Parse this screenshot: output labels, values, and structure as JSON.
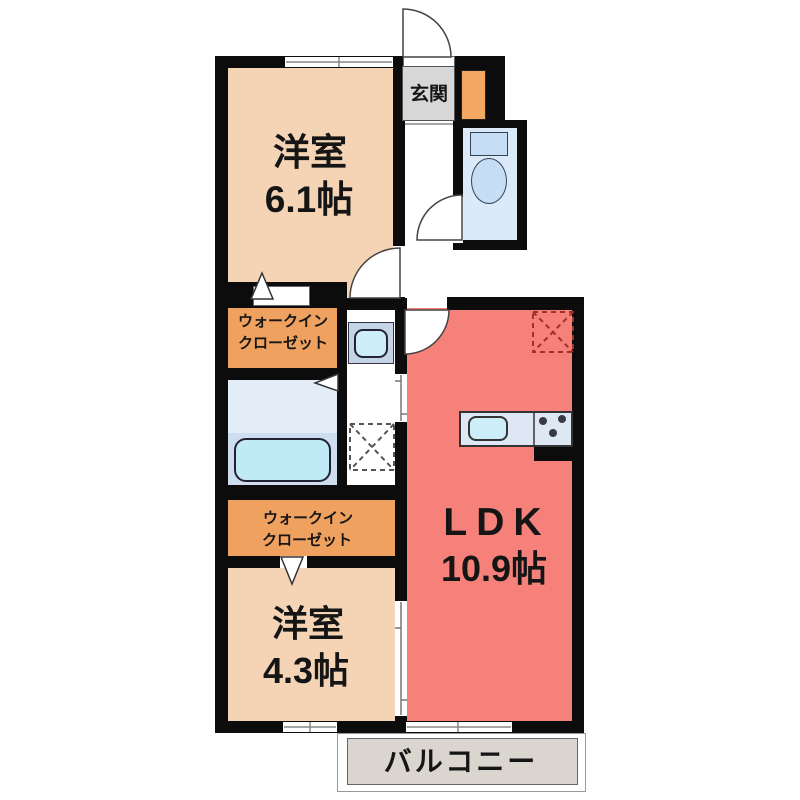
{
  "palette": {
    "wall": "#0c0c0c",
    "bedroom": "#f4d4b5",
    "ldk": "#f5817a",
    "wic": "#efa160",
    "shoe": "#f2a763",
    "genkan": "#d7d7d7",
    "water": "#dce9f8",
    "bath_upper": "#e3edf8",
    "bath_lower": "#cfdeee",
    "tub": "#c0eaf5",
    "fixture": "#c5ddf5",
    "wash_unit": "#c4d5e8",
    "sink": "#cdeef8",
    "counter": "#dde8f4",
    "balcony": "#dbd5cf",
    "white": "#ffffff"
  },
  "labels": {
    "entrance": "玄関",
    "bedroom1": {
      "name": "洋室",
      "size": "6.1帖"
    },
    "bedroom2": {
      "name": "洋室",
      "size": "4.3帖"
    },
    "ldk": {
      "name": "LDK",
      "size": "10.9帖"
    },
    "wic1": {
      "line1": "ウォークイン",
      "line2": "クローゼット"
    },
    "wic2": {
      "line1": "ウォークイン",
      "line2": "クローゼット"
    },
    "balcony": "バルコニー"
  }
}
